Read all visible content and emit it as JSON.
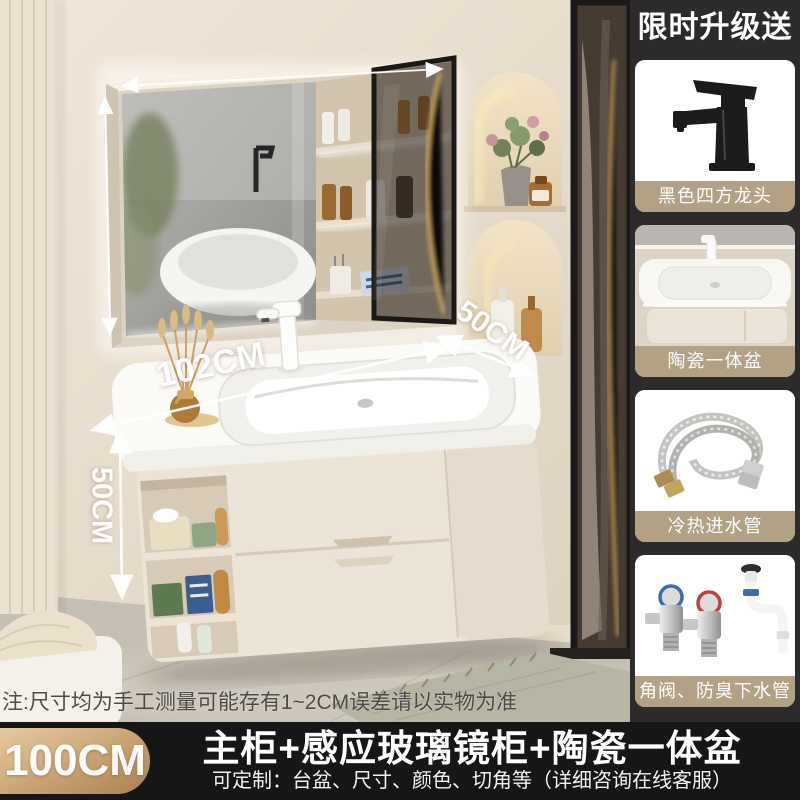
{
  "photo": {
    "dimensions": {
      "width": "102CM",
      "depth": "50CM",
      "height": "50CM"
    },
    "note": "注:尺寸均为手工测量可能存有1~2CM误差请以实物为准"
  },
  "sidebar": {
    "header": "限时升级送",
    "items": [
      {
        "label": "黑色四方龙头",
        "icon": "black-square-faucet-image"
      },
      {
        "label": "陶瓷一体盆",
        "icon": "ceramic-basin-image"
      },
      {
        "label": "冷热进水管",
        "icon": "water-inlet-hoses-image"
      },
      {
        "label": "角阀、防臭下水管",
        "icon": "angle-valve-drain-image"
      }
    ]
  },
  "footer": {
    "size_badge": "100CM",
    "title": "主柜+感应玻璃镜柜+陶瓷一体盆",
    "subtitle": "可定制：台盆、尺寸、颜色、切角等（详细咨询在线客服）"
  },
  "colors": {
    "sidebar_bg": "#2c2a2b",
    "footer_bg": "#171616",
    "gift_label_tan": "#b3a185",
    "badge_gold_light": "#e6cba0",
    "badge_gold_dark": "#a87f52",
    "wall_beige": "#e8ddcd",
    "annotation_white": "#ffffff"
  }
}
